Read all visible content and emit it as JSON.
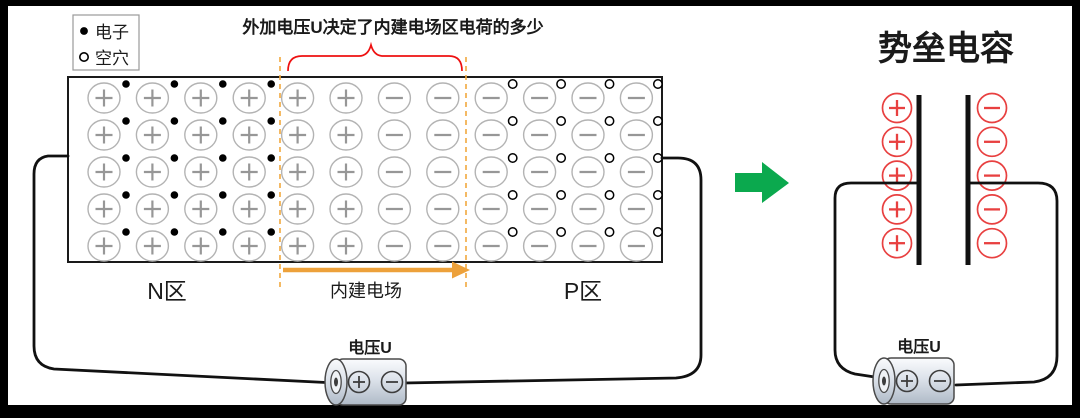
{
  "legend": {
    "items": [
      {
        "icon": "electron-dot",
        "label": "电子"
      },
      {
        "icon": "hole-circle",
        "label": "空穴"
      }
    ]
  },
  "annotation": {
    "text": "外加电压U决定了内建电场区电荷的多少",
    "color": "#EE1111"
  },
  "pn_junction": {
    "rows": 5,
    "n_region": {
      "label": "N区",
      "label_color": "#4E7D9E",
      "columns": 4,
      "ion_symbol": "+",
      "carrier": "electron"
    },
    "depletion_region": {
      "label": "内建电场",
      "label_color": "#1a1a1a",
      "plus_columns": 2,
      "minus_columns": 2,
      "boundary_color": "#F2A83E",
      "arrow_color": "#EDA13B"
    },
    "p_region": {
      "label": "P区",
      "label_color": "#96713B",
      "columns": 4,
      "ion_symbol": "−",
      "carrier": "hole"
    }
  },
  "left_circuit": {
    "battery_label": "电压U",
    "battery_positive": "+",
    "battery_negative": "−"
  },
  "equivalence_arrow": {
    "color": "#0BA94E"
  },
  "capacitor": {
    "title": "势垒电容",
    "title_color": "#7030A0",
    "plus_charges": {
      "count": 5,
      "symbol": "+",
      "color": "#E84040"
    },
    "minus_charges": {
      "count": 5,
      "symbol": "−",
      "color": "#E84040"
    }
  },
  "right_circuit": {
    "battery_label": "电压U",
    "battery_positive": "+",
    "battery_negative": "−"
  }
}
